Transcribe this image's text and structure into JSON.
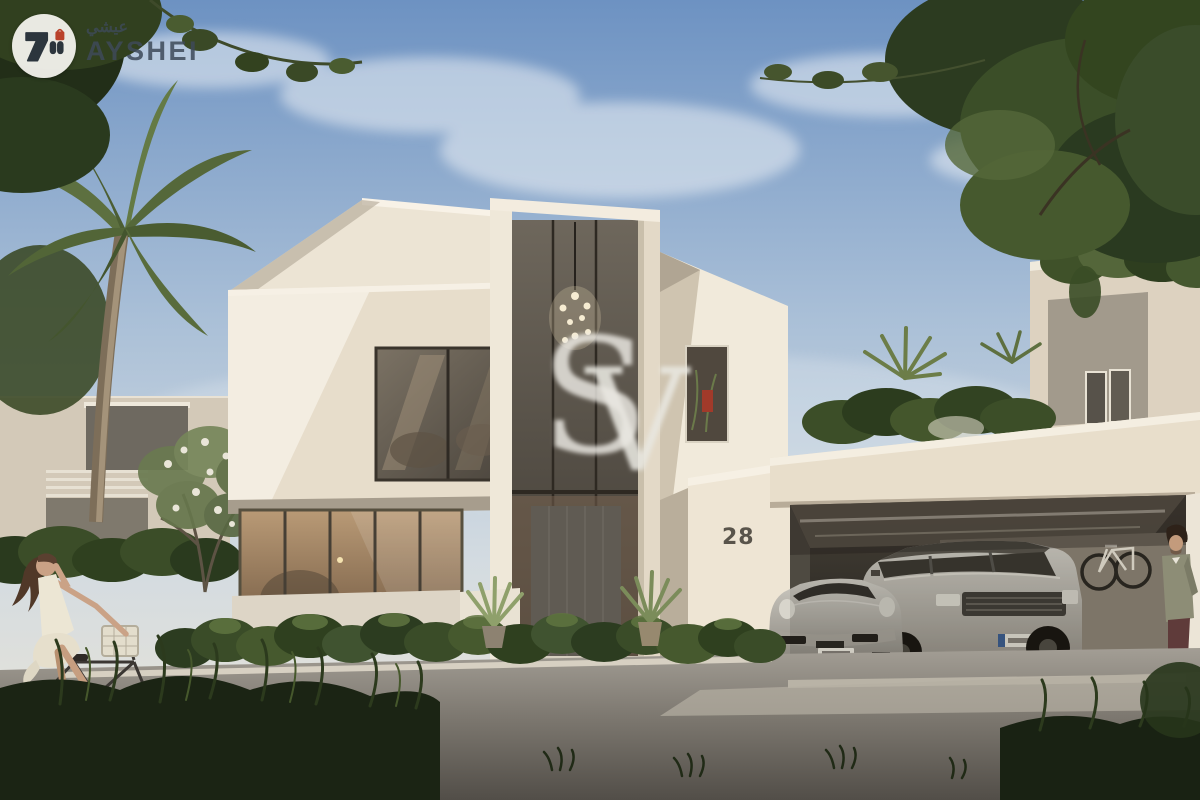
{
  "brand": {
    "name": "AYSHEI",
    "name_arabic": "عيشي",
    "colors": {
      "badge": "#f7f6f1",
      "mark": "#2c3540",
      "accent": "#c5432c",
      "text": "#3e4a59"
    }
  },
  "watermark": {
    "letter_s": "S",
    "letter_v": "V",
    "color": "#edebe5"
  },
  "villa": {
    "house_number": "28",
    "number_color": "#59544b"
  },
  "palette": {
    "sky_top": "#6d92c2",
    "sky_horizon": "#dfe0dc",
    "wall_sunlit": "#f3ece0",
    "wall_light": "#e9dfcd",
    "wall_shadow": "#b3a896",
    "glass_dark": "#4a443c",
    "garage_dark": "#27231d",
    "road": "#8d8982",
    "foliage_dark": "#26331c",
    "foliage_light": "#7c8f58",
    "car_silver": "#c0bcb3"
  }
}
